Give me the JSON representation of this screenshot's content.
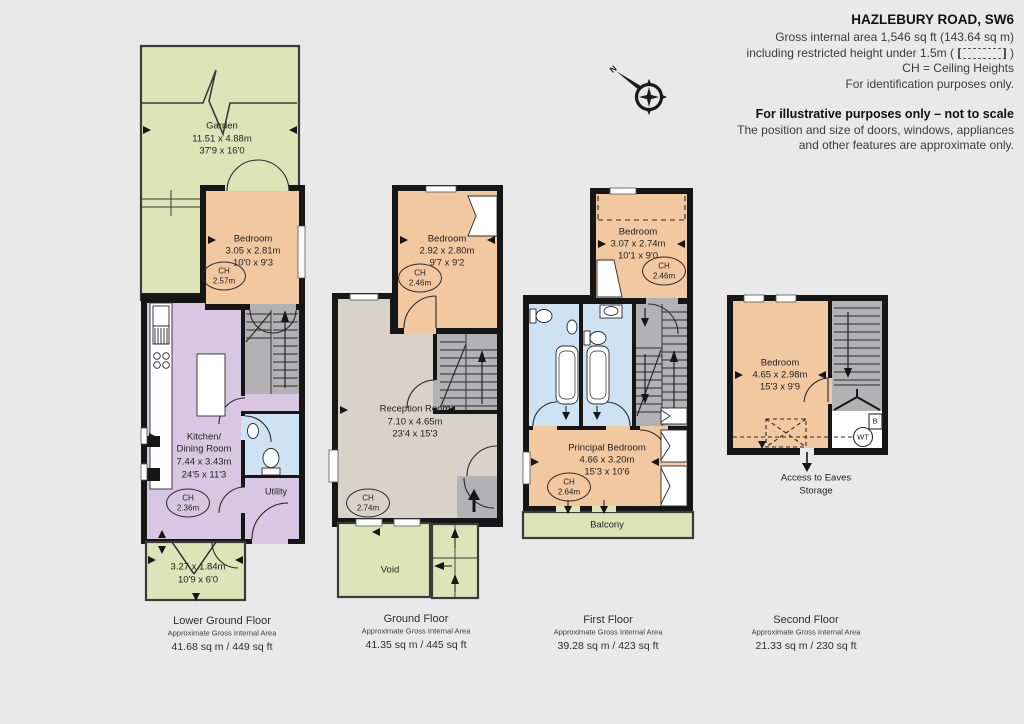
{
  "header": {
    "title": "HAZLEBURY ROAD, SW6",
    "gross_area": "Gross internal area 1,546 sq ft (143.64 sq m)",
    "restricted_prefix": "including restricted height under 1.5m (",
    "restricted_suffix": ")",
    "ch_legend": "CH =  Ceiling Heights",
    "identification": "For identification purposes only.",
    "illustrative": "For illustrative purposes only – not to scale",
    "disclaimer1": "The position and size of doors, windows, appliances",
    "disclaimer2": "and other features are approximate only."
  },
  "compass": {
    "north_label": "N"
  },
  "floors": {
    "lower_ground": {
      "caption": {
        "title": "Lower Ground Floor",
        "subtitle": "Approximate Gross Internal Area",
        "area": "41.68 sq m  /  449 sq ft"
      },
      "garden": {
        "name": "Garden",
        "metric": "11.51 x 4.88m",
        "imperial": "37'9 x 16'0"
      },
      "bedroom": {
        "name": "Bedroom",
        "metric": "3.05 x 2.81m",
        "imperial": "10'0 x 9'3",
        "ch_label": "CH",
        "ch_value": "2.57m"
      },
      "kitchen": {
        "name_line1": "Kitchen/",
        "name_line2": "Dining Room",
        "metric": "7.44 x 3.43m",
        "imperial": "24'5 x 11'3",
        "ch_label": "CH",
        "ch_value": "2.36m"
      },
      "utility": {
        "name": "Utility"
      },
      "patio": {
        "metric": "3.27 x 1.84m",
        "imperial": "10'9 x 6'0"
      }
    },
    "ground": {
      "caption": {
        "title": "Ground Floor",
        "subtitle": "Approximate Gross Internal Area",
        "area": "41.35 sq m  /  445 sq ft"
      },
      "bedroom": {
        "name": "Bedroom",
        "metric": "2.92 x 2.80m",
        "imperial": "9'7 x 9'2",
        "ch_label": "CH",
        "ch_value": "2.46m"
      },
      "reception": {
        "name": "Reception Room",
        "metric": "7.10 x 4.65m",
        "imperial": "23'4 x 15'3",
        "ch_label": "CH",
        "ch_value": "2.74m"
      },
      "void": {
        "name": "Void"
      }
    },
    "first": {
      "caption": {
        "title": "First Floor",
        "subtitle": "Approximate Gross Internal Area",
        "area": "39.28 sq m  /  423 sq ft"
      },
      "bedroom": {
        "name": "Bedroom",
        "metric": "3.07 x 2.74m",
        "imperial": "10'1 x 9'0",
        "ch_label": "CH",
        "ch_value": "2.46m"
      },
      "principal": {
        "name": "Principal Bedroom",
        "metric": "4.66 x 3.20m",
        "imperial": "15'3 x 10'6",
        "ch_label": "CH",
        "ch_value": "2.64m"
      },
      "balcony": {
        "name": "Balcony"
      }
    },
    "second": {
      "caption": {
        "title": "Second Floor",
        "subtitle": "Approximate Gross Internal Area",
        "area": "21.33 sq m  /  230 sq ft"
      },
      "bedroom": {
        "name": "Bedroom",
        "metric": "4.65 x 2.98m",
        "imperial": "15'3 x 9'9"
      },
      "boiler_label": "B",
      "water_tank_label": "WT",
      "eaves_line1": "Access to Eaves",
      "eaves_line2": "Storage"
    }
  },
  "colors": {
    "background": "#e9e9e9",
    "wall": "#161616",
    "garden_green": "#dde5b8",
    "bedroom_peach": "#f2c8a0",
    "kitchen_purple": "#d9c6e3",
    "reception_taupe": "#d9d2c8",
    "bathroom_blue": "#cde2f2",
    "stairs_gray": "#b2b2b4"
  }
}
